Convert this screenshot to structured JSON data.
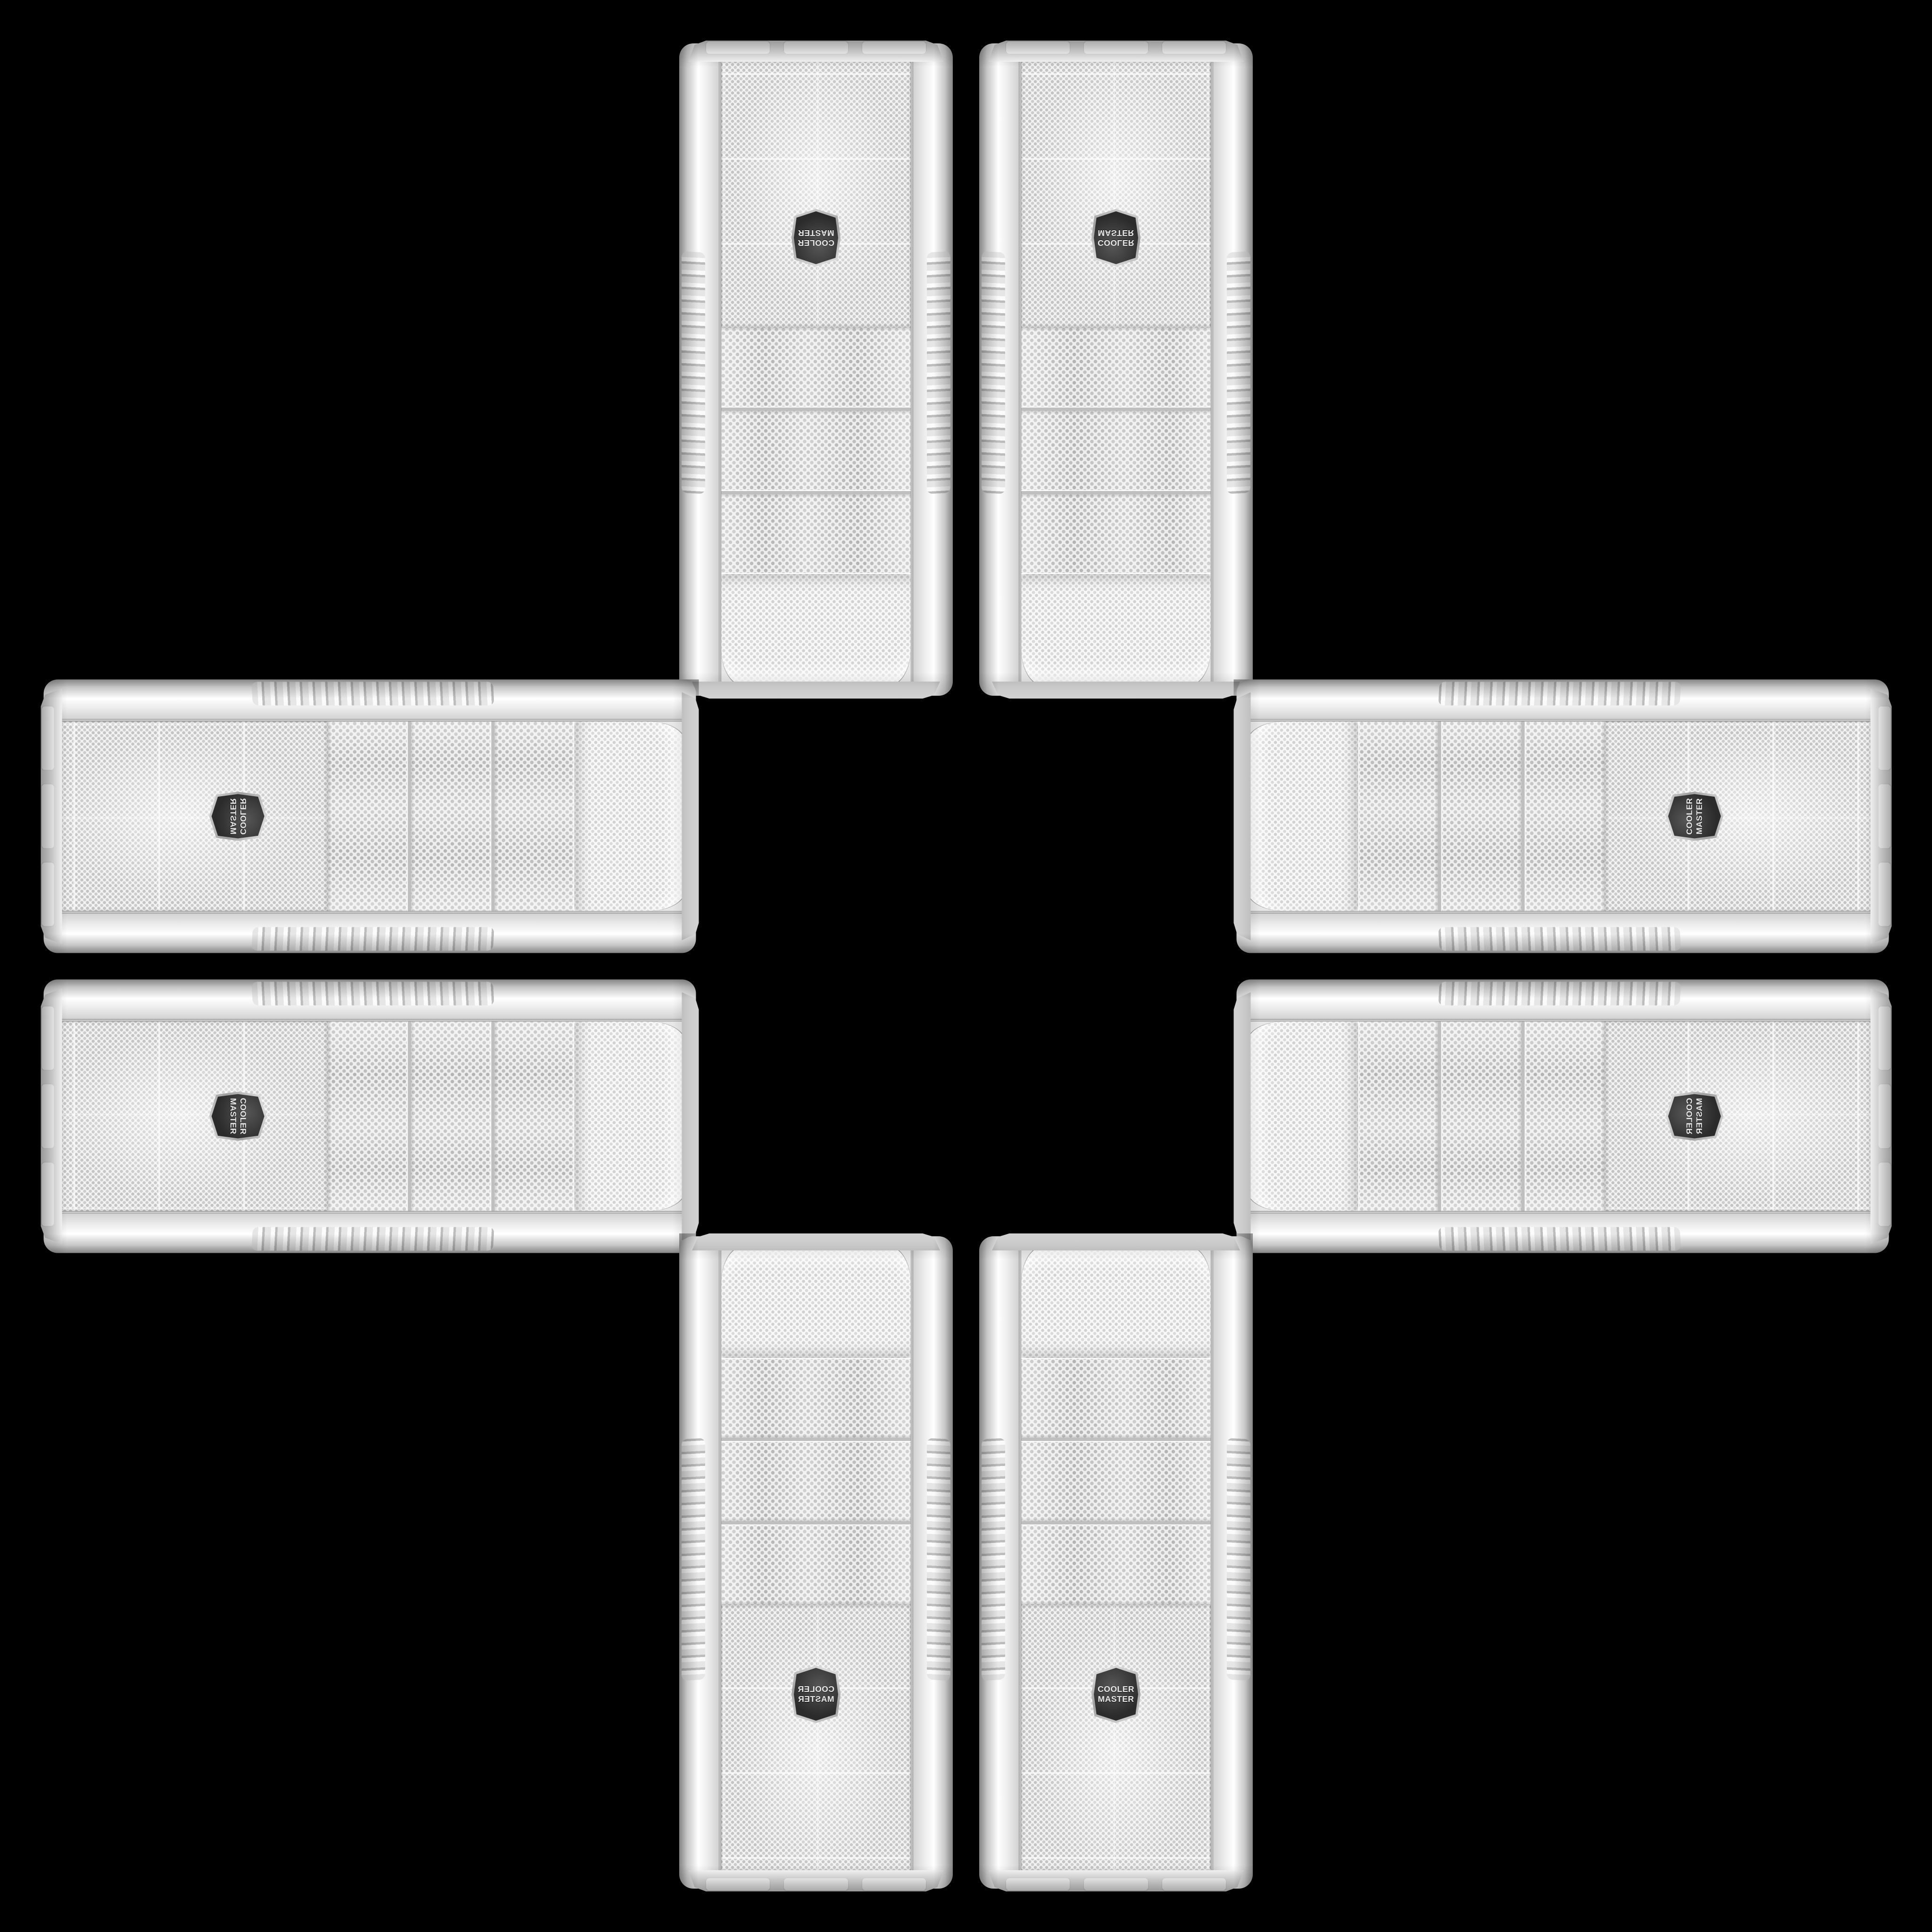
{
  "scene": {
    "background_color": "#000000",
    "arrangement": "eight identical white PC tower cases arranged in a plus cross pattern, mirrored and rotated copies",
    "case_count": 8
  },
  "brand": "Cooler Master",
  "logo": {
    "line1": "COOLER",
    "line2": "MASTER"
  },
  "colors": {
    "case_white": "#f3f3f3",
    "rail_highlight": "#ffffff",
    "rail_shadow": "#b9b9b9",
    "mesh_dot": "#c4c4c4",
    "bay_dot": "#b3b3b3",
    "trim_chrome": "#9c9c9c",
    "logo_face": "#2b2b2b",
    "logo_ring": "#c9c9c9",
    "logo_text": "#e9e9e9"
  }
}
